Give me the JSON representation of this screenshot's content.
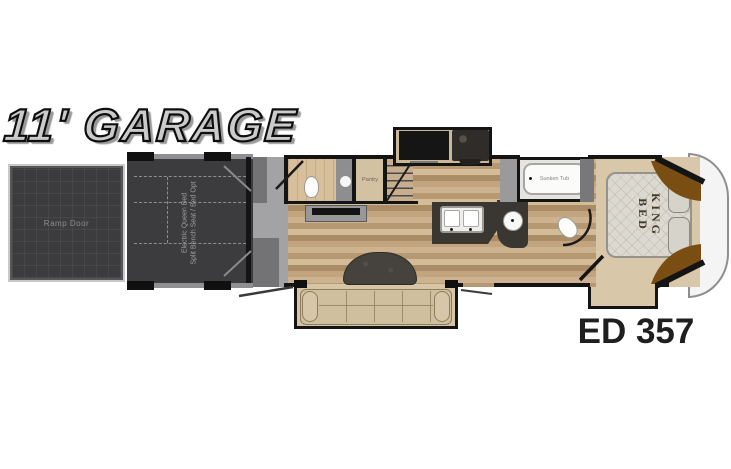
{
  "diagram": {
    "title": "11' GARAGE",
    "model": "ED 357",
    "labels": {
      "ramp_door": "Ramp Door",
      "garage_bed_line1": "Electric Queen Bed",
      "garage_bed_line2": "Split Bench Seat / Bed Opt",
      "pantry": "Pantry",
      "sunken_tub": "Sunken Tub",
      "king_bed_line1": "KING",
      "king_bed_line2": "BED"
    },
    "fixtures": [
      "ramp-door",
      "garage-queen-bed-outline",
      "half-bath-toilet",
      "half-bath-sink",
      "pantry",
      "stairs",
      "tv",
      "range-cooktop",
      "entertainment-console",
      "kitchen-island-double-sink",
      "vanity-round-sink",
      "sunken-tub",
      "bath-toilet",
      "king-bed",
      "pillows",
      "wardrobe-cabinets",
      "sofa",
      "dinette-table",
      "entry-doors",
      "front-cap"
    ],
    "colors": {
      "wall": "#141414",
      "garage_floor": "#3c3c3e",
      "wood_floor": "#c0a37e",
      "bedroom_floor": "#d9c7aa",
      "counter_dark": "#3a3733",
      "cabinet_brown": "#7a4e12",
      "sofa_beige": "#cfbf9f",
      "title_fill": "#cbcbcb",
      "model_text": "#1f1f1f"
    }
  }
}
